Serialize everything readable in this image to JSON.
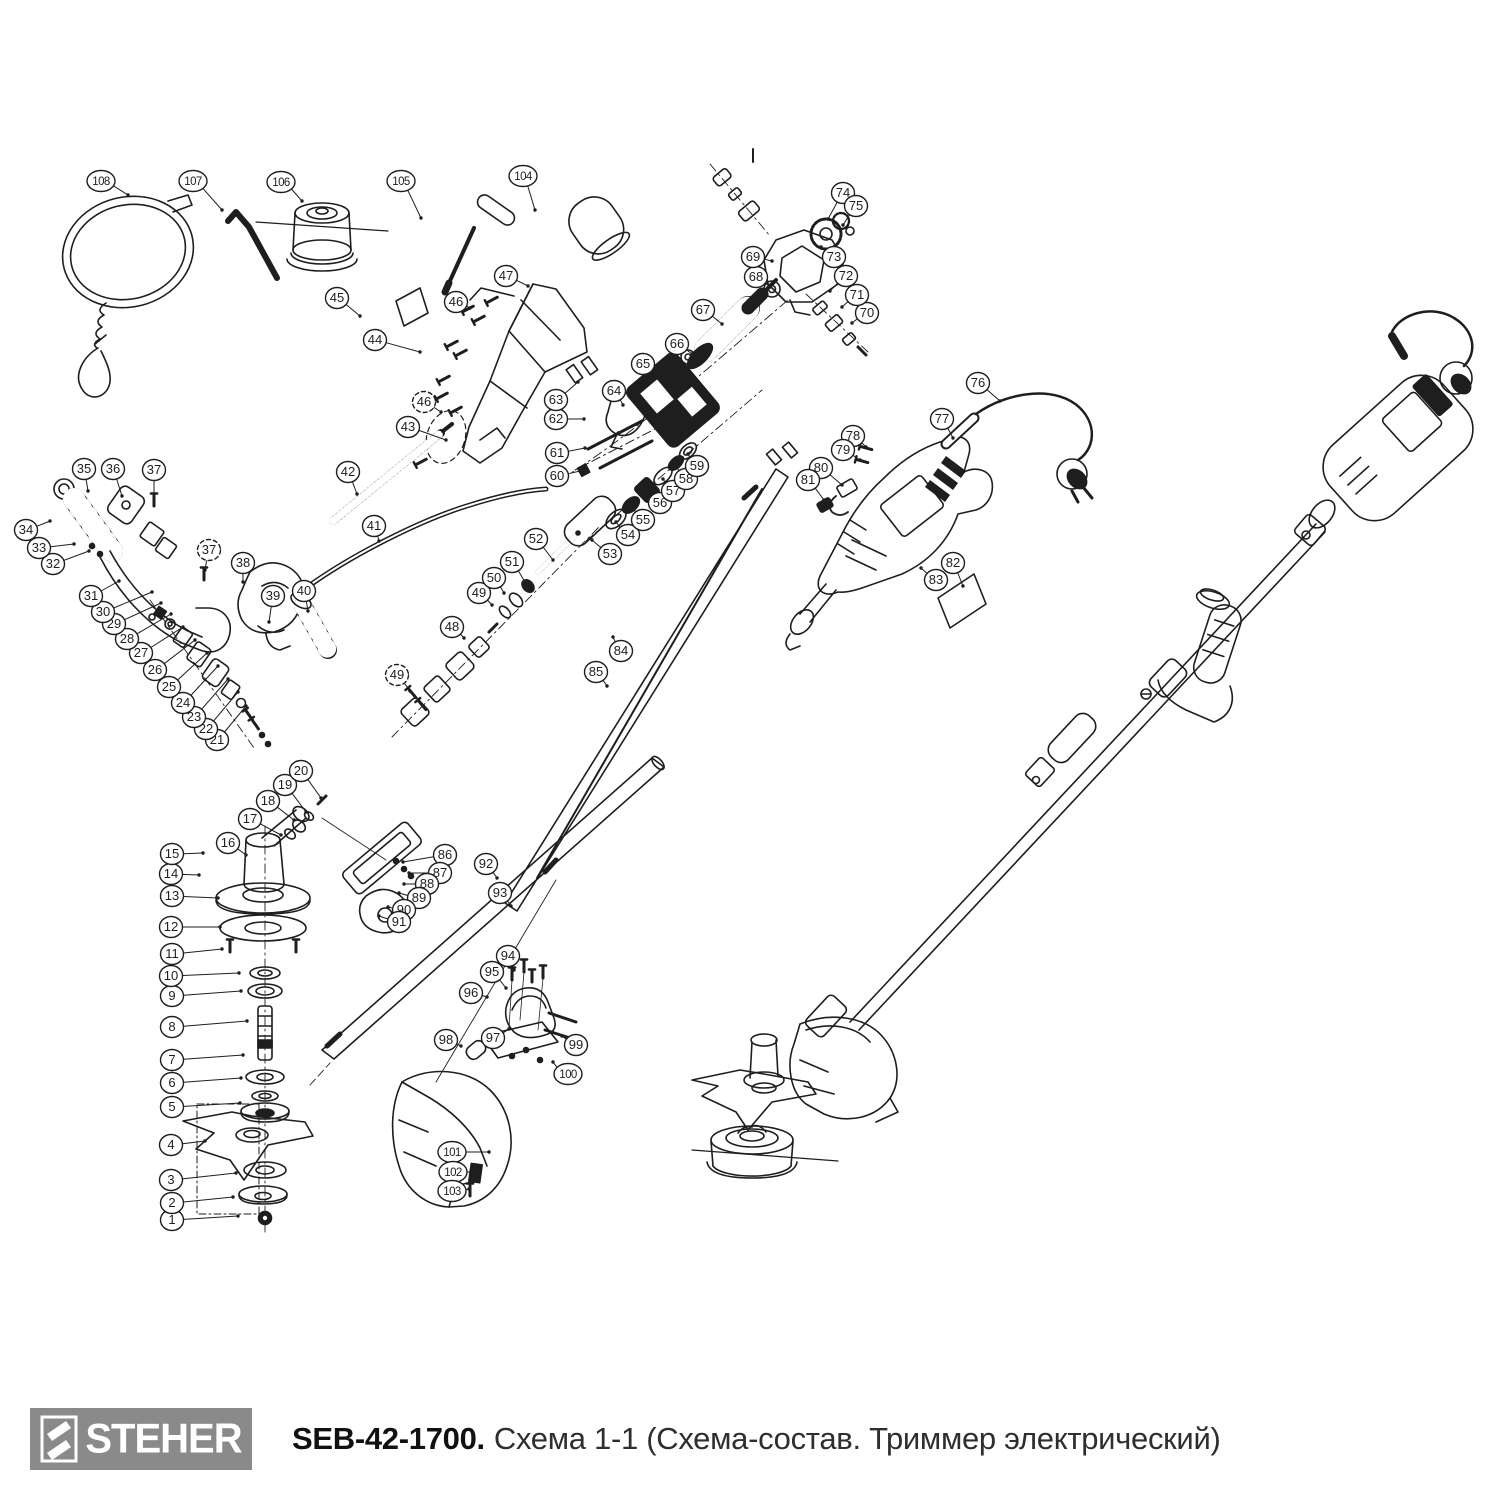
{
  "footer": {
    "brand": "STEHER",
    "model": "SEB-42-1700.",
    "title": "Схема 1-1 (Схема-состав. Триммер электрический)"
  },
  "colors": {
    "ink": "#1e1e1e",
    "logo_bg": "#8a8a8a"
  },
  "callouts": [
    {
      "n": "1",
      "x": 172,
      "y": 1220,
      "tx": 238,
      "ty": 1216
    },
    {
      "n": "2",
      "x": 172,
      "y": 1203,
      "tx": 233,
      "ty": 1197
    },
    {
      "n": "3",
      "x": 171,
      "y": 1180,
      "tx": 236,
      "ty": 1173
    },
    {
      "n": "4",
      "x": 171,
      "y": 1145,
      "tx": 205,
      "ty": 1141
    },
    {
      "n": "5",
      "x": 172,
      "y": 1107,
      "tx": 240,
      "ty": 1103
    },
    {
      "n": "6",
      "x": 172,
      "y": 1083,
      "tx": 241,
      "ty": 1078
    },
    {
      "n": "7",
      "x": 172,
      "y": 1060,
      "tx": 243,
      "ty": 1055
    },
    {
      "n": "8",
      "x": 172,
      "y": 1027,
      "tx": 247,
      "ty": 1021
    },
    {
      "n": "9",
      "x": 172,
      "y": 996,
      "tx": 241,
      "ty": 991
    },
    {
      "n": "10",
      "x": 171,
      "y": 976,
      "tx": 239,
      "ty": 973
    },
    {
      "n": "11",
      "x": 172,
      "y": 954,
      "tx": 222,
      "ty": 949
    },
    {
      "n": "12",
      "x": 171,
      "y": 927,
      "tx": 220,
      "ty": 927
    },
    {
      "n": "13",
      "x": 172,
      "y": 896,
      "tx": 218,
      "ty": 898
    },
    {
      "n": "14",
      "x": 171,
      "y": 874,
      "tx": 199,
      "ty": 875
    },
    {
      "n": "15",
      "x": 172,
      "y": 854,
      "tx": 203,
      "ty": 853
    },
    {
      "n": "16",
      "x": 228,
      "y": 843,
      "tx": 246,
      "ty": 855
    },
    {
      "n": "17",
      "x": 250,
      "y": 819,
      "tx": 281,
      "ty": 835
    },
    {
      "n": "18",
      "x": 268,
      "y": 801,
      "tx": 294,
      "ty": 820
    },
    {
      "n": "19",
      "x": 285,
      "y": 785,
      "tx": 306,
      "ty": 812
    },
    {
      "n": "20",
      "x": 301,
      "y": 771,
      "tx": 321,
      "ty": 798
    },
    {
      "n": "21",
      "x": 217,
      "y": 740,
      "tx": 246,
      "ty": 706
    },
    {
      "n": "22",
      "x": 206,
      "y": 729,
      "tx": 238,
      "ty": 692
    },
    {
      "n": "23",
      "x": 194,
      "y": 717,
      "tx": 228,
      "ty": 679
    },
    {
      "n": "24",
      "x": 183,
      "y": 703,
      "tx": 218,
      "ty": 666
    },
    {
      "n": "25",
      "x": 169,
      "y": 687,
      "tx": 207,
      "ty": 653
    },
    {
      "n": "26",
      "x": 155,
      "y": 670,
      "tx": 195,
      "ty": 640
    },
    {
      "n": "27",
      "x": 141,
      "y": 653,
      "tx": 183,
      "ty": 627
    },
    {
      "n": "28",
      "x": 127,
      "y": 639,
      "tx": 171,
      "ty": 614
    },
    {
      "n": "29",
      "x": 114,
      "y": 624,
      "tx": 161,
      "ty": 603
    },
    {
      "n": "30",
      "x": 103,
      "y": 612,
      "tx": 152,
      "ty": 592
    },
    {
      "n": "31",
      "x": 91,
      "y": 596,
      "tx": 119,
      "ty": 581
    },
    {
      "n": "32",
      "x": 53,
      "y": 564,
      "tx": 89,
      "ty": 551
    },
    {
      "n": "33",
      "x": 39,
      "y": 548,
      "tx": 74,
      "ty": 544
    },
    {
      "n": "34",
      "x": 26,
      "y": 530,
      "tx": 50,
      "ty": 521
    },
    {
      "n": "35",
      "x": 84,
      "y": 469,
      "tx": 88,
      "ty": 491
    },
    {
      "n": "36",
      "x": 113,
      "y": 469,
      "tx": 122,
      "ty": 496
    },
    {
      "n": "37",
      "x": 154,
      "y": 470,
      "tx": 154,
      "ty": 494
    },
    {
      "n": "37",
      "x": 209,
      "y": 550,
      "tx": 205,
      "ty": 570,
      "dashed": true
    },
    {
      "n": "38",
      "x": 243,
      "y": 563,
      "tx": 243,
      "ty": 582
    },
    {
      "n": "39",
      "x": 273,
      "y": 596,
      "tx": 269,
      "ty": 622
    },
    {
      "n": "40",
      "x": 304,
      "y": 591,
      "tx": 308,
      "ty": 611
    },
    {
      "n": "41",
      "x": 374,
      "y": 526,
      "tx": 379,
      "ty": 541
    },
    {
      "n": "42",
      "x": 348,
      "y": 472,
      "tx": 357,
      "ty": 494
    },
    {
      "n": "43",
      "x": 408,
      "y": 427,
      "tx": 446,
      "ty": 440
    },
    {
      "n": "44",
      "x": 375,
      "y": 340,
      "tx": 420,
      "ty": 352
    },
    {
      "n": "45",
      "x": 337,
      "y": 298,
      "tx": 360,
      "ty": 316
    },
    {
      "n": "46",
      "x": 456,
      "y": 302,
      "tx": 470,
      "ty": 308
    },
    {
      "n": "46",
      "x": 424,
      "y": 402,
      "tx": 441,
      "ty": 412,
      "dashed": true
    },
    {
      "n": "47",
      "x": 506,
      "y": 276,
      "tx": 528,
      "ty": 286
    },
    {
      "n": "48",
      "x": 452,
      "y": 627,
      "tx": 464,
      "ty": 638
    },
    {
      "n": "49",
      "x": 479,
      "y": 593,
      "tx": 492,
      "ty": 605
    },
    {
      "n": "49",
      "x": 397,
      "y": 675,
      "tx": 410,
      "ty": 691,
      "dashed": true
    },
    {
      "n": "50",
      "x": 494,
      "y": 578,
      "tx": 504,
      "ty": 593
    },
    {
      "n": "51",
      "x": 512,
      "y": 562,
      "tx": 525,
      "ty": 582
    },
    {
      "n": "52",
      "x": 536,
      "y": 539,
      "tx": 553,
      "ty": 560
    },
    {
      "n": "53",
      "x": 610,
      "y": 554,
      "tx": 592,
      "ty": 540
    },
    {
      "n": "54",
      "x": 628,
      "y": 535,
      "tx": 616,
      "ty": 522
    },
    {
      "n": "55",
      "x": 643,
      "y": 520,
      "tx": 632,
      "ty": 507
    },
    {
      "n": "56",
      "x": 660,
      "y": 503,
      "tx": 648,
      "ty": 492
    },
    {
      "n": "57",
      "x": 673,
      "y": 491,
      "tx": 663,
      "ty": 479
    },
    {
      "n": "58",
      "x": 686,
      "y": 479,
      "tx": 676,
      "ty": 466
    },
    {
      "n": "59",
      "x": 697,
      "y": 466,
      "tx": 688,
      "ty": 454
    },
    {
      "n": "60",
      "x": 557,
      "y": 476,
      "tx": 580,
      "ty": 471
    },
    {
      "n": "61",
      "x": 557,
      "y": 453,
      "tx": 585,
      "ty": 448
    },
    {
      "n": "62",
      "x": 556,
      "y": 419,
      "tx": 584,
      "ty": 419
    },
    {
      "n": "63",
      "x": 556,
      "y": 400,
      "tx": 578,
      "ty": 382
    },
    {
      "n": "64",
      "x": 614,
      "y": 391,
      "tx": 623,
      "ty": 405
    },
    {
      "n": "65",
      "x": 643,
      "y": 364,
      "tx": 662,
      "ty": 380
    },
    {
      "n": "66",
      "x": 677,
      "y": 344,
      "tx": 692,
      "ty": 354
    },
    {
      "n": "67",
      "x": 703,
      "y": 310,
      "tx": 722,
      "ty": 324
    },
    {
      "n": "68",
      "x": 756,
      "y": 277,
      "tx": 770,
      "ty": 287
    },
    {
      "n": "69",
      "x": 753,
      "y": 257,
      "tx": 772,
      "ty": 261
    },
    {
      "n": "70",
      "x": 867,
      "y": 313,
      "tx": 852,
      "ty": 323
    },
    {
      "n": "71",
      "x": 857,
      "y": 295,
      "tx": 842,
      "ty": 307
    },
    {
      "n": "72",
      "x": 846,
      "y": 276,
      "tx": 830,
      "ty": 291
    },
    {
      "n": "73",
      "x": 834,
      "y": 257,
      "tx": 821,
      "ty": 247
    },
    {
      "n": "74",
      "x": 843,
      "y": 193,
      "tx": 828,
      "ty": 219
    },
    {
      "n": "75",
      "x": 856,
      "y": 206,
      "tx": 843,
      "ty": 225
    },
    {
      "n": "76",
      "x": 978,
      "y": 383,
      "tx": 1000,
      "ty": 401
    },
    {
      "n": "77",
      "x": 942,
      "y": 419,
      "tx": 953,
      "ty": 438
    },
    {
      "n": "78",
      "x": 853,
      "y": 436,
      "tx": 866,
      "ty": 447
    },
    {
      "n": "79",
      "x": 843,
      "y": 450,
      "tx": 860,
      "ty": 460
    },
    {
      "n": "80",
      "x": 821,
      "y": 468,
      "tx": 842,
      "ty": 485
    },
    {
      "n": "81",
      "x": 808,
      "y": 480,
      "tx": 824,
      "ty": 500
    },
    {
      "n": "82",
      "x": 953,
      "y": 563,
      "tx": 963,
      "ty": 586
    },
    {
      "n": "83",
      "x": 936,
      "y": 580,
      "tx": 921,
      "ty": 568
    },
    {
      "n": "84",
      "x": 621,
      "y": 651,
      "tx": 613,
      "ty": 637
    },
    {
      "n": "85",
      "x": 596,
      "y": 672,
      "tx": 607,
      "ty": 686
    },
    {
      "n": "86",
      "x": 445,
      "y": 855,
      "tx": 403,
      "ty": 862
    },
    {
      "n": "87",
      "x": 440,
      "y": 873,
      "tx": 409,
      "ty": 873
    },
    {
      "n": "88",
      "x": 427,
      "y": 884,
      "tx": 404,
      "ty": 884
    },
    {
      "n": "89",
      "x": 419,
      "y": 898,
      "tx": 399,
      "ty": 893
    },
    {
      "n": "90",
      "x": 404,
      "y": 910,
      "tx": 388,
      "ty": 907
    },
    {
      "n": "91",
      "x": 399,
      "y": 922,
      "tx": 379,
      "ty": 916
    },
    {
      "n": "92",
      "x": 486,
      "y": 864,
      "tx": 497,
      "ty": 878
    },
    {
      "n": "93",
      "x": 500,
      "y": 893,
      "tx": 511,
      "ty": 906
    },
    {
      "n": "94",
      "x": 508,
      "y": 956,
      "tx": 514,
      "ty": 970
    },
    {
      "n": "95",
      "x": 492,
      "y": 972,
      "tx": 506,
      "ty": 988
    },
    {
      "n": "96",
      "x": 471,
      "y": 993,
      "tx": 487,
      "ty": 997
    },
    {
      "n": "97",
      "x": 493,
      "y": 1038,
      "tx": 509,
      "ty": 1029
    },
    {
      "n": "98",
      "x": 446,
      "y": 1040,
      "tx": 461,
      "ty": 1046
    },
    {
      "n": "99",
      "x": 576,
      "y": 1045,
      "tx": 562,
      "ty": 1036
    },
    {
      "n": "100",
      "x": 568,
      "y": 1074,
      "tx": 553,
      "ty": 1062
    },
    {
      "n": "101",
      "x": 452,
      "y": 1152,
      "tx": 489,
      "ty": 1152
    },
    {
      "n": "102",
      "x": 453,
      "y": 1172,
      "tx": 471,
      "ty": 1172
    },
    {
      "n": "103",
      "x": 452,
      "y": 1191,
      "tx": 469,
      "ty": 1189
    },
    {
      "n": "104",
      "x": 523,
      "y": 176,
      "tx": 535,
      "ty": 210
    },
    {
      "n": "105",
      "x": 401,
      "y": 181,
      "tx": 421,
      "ty": 218
    },
    {
      "n": "106",
      "x": 281,
      "y": 182,
      "tx": 302,
      "ty": 201
    },
    {
      "n": "107",
      "x": 193,
      "y": 181,
      "tx": 222,
      "ty": 210
    },
    {
      "n": "108",
      "x": 101,
      "y": 181,
      "tx": 128,
      "ty": 195
    }
  ]
}
